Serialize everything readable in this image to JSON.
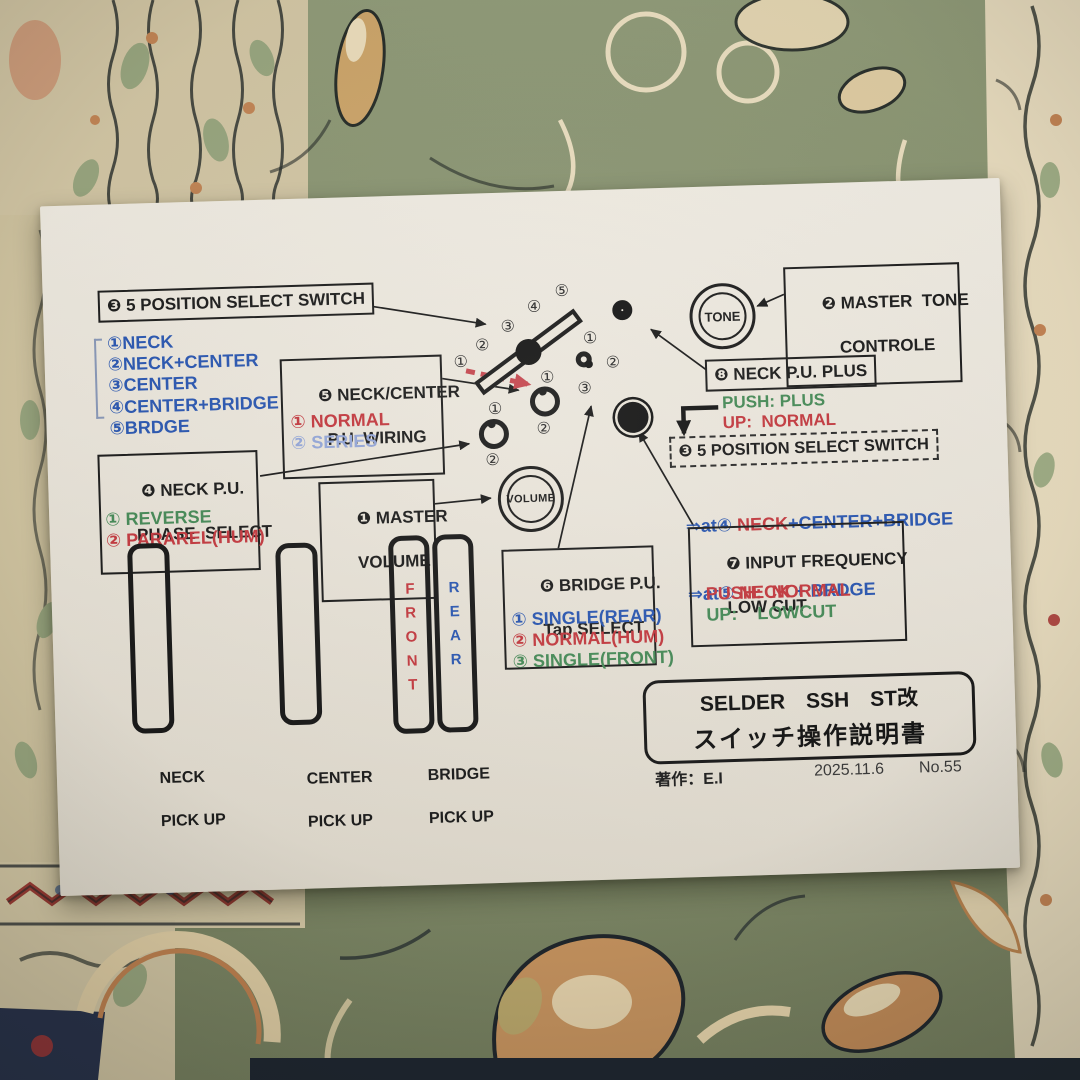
{
  "colors": {
    "accent_blue": "#2b57b0",
    "accent_red": "#c23a40",
    "accent_green": "#478a58",
    "pale_blue": "#93a5d6",
    "dash_arrow_red": "#c4474f",
    "paper": "#e8e3d9",
    "carpet_green": "#87926e",
    "carpet_beige": "#cfc3a2"
  },
  "boxes": {
    "master_volume": {
      "line1": "❶ MASTER",
      "line2": "VOLUME"
    },
    "master_tone": {
      "line1": "❷ MASTER  TONE",
      "line2": "CONTROLE"
    },
    "select_switch": {
      "title": "❸ 5 POSITION SELECT SWITCH"
    },
    "phase_select": {
      "line1": "❹ NECK P.U.",
      "line2": "PHASE  SELECT"
    },
    "pu_wiring": {
      "line1": "❺ NECK/CENTER",
      "line2": "P.U. WIRING"
    },
    "bridge_tap": {
      "line1": "❻ BRIDGE P.U.",
      "line2": "Tap SELECT"
    },
    "input_freq": {
      "line1": "❼ INPUT FREQUENCY",
      "line2": "LOW CUT"
    },
    "neck_plus": {
      "title": "❽ NECK P.U. PLUS"
    },
    "select_switch_pushed": {
      "title": "❸ 5 POSITION SELECT SWITCH"
    }
  },
  "lists": {
    "select_positions": [
      "①NECK",
      "②NECK+CENTER",
      "③CENTER",
      "④CENTER+BRIDGE",
      "⑤BRDGE"
    ],
    "wiring_options": [
      "① NORMAL",
      "② SERIES"
    ],
    "phase_options": [
      "① REVERSE",
      "② PARAREL(HUM)"
    ],
    "tap_options": [
      "① SINGLE(REAR)",
      "② NORMAL(HUM)",
      "③ SINGLE(FRONT)"
    ],
    "neck_plus_push": "PUSH: PLUS",
    "neck_plus_up": "UP:  NORMAL",
    "input_freq_push": "PUSH:  NORMAL",
    "input_freq_up": "UP:    LOWCUT",
    "pushed_row1": {
      "pre": "⇒at④ ",
      "neck": "NECK",
      "rest": "+CENTER+BRIDGE"
    },
    "pushed_row2": {
      "pre": "⇒at⑤ ",
      "neck": "NECK",
      "rest": " + BRDGE"
    }
  },
  "knobs": {
    "volume_label": "VOLUME",
    "tone_label": "TONE"
  },
  "pot_labels": {
    "fan": [
      "①",
      "②",
      "③",
      "④",
      "⑤"
    ],
    "wiring": [
      "①",
      "②"
    ],
    "phase": [
      "①",
      "②"
    ],
    "tap": [
      "①",
      "②",
      "③"
    ]
  },
  "pickups": {
    "neck": {
      "line1": "NECK",
      "line2": "PICK UP"
    },
    "center": {
      "line1": "CENTER",
      "line2": "PICK UP"
    },
    "bridge": {
      "line1": "BRIDGE",
      "line2": "PICK UP",
      "front": "FRONT",
      "rear": "REAR"
    }
  },
  "footer": {
    "title_line1": "SELDER　SSH　ST改",
    "title_line2": "スイッチ操作説明書",
    "author": "著作：E.I",
    "date": "2025.11.6",
    "number": "No.55"
  }
}
